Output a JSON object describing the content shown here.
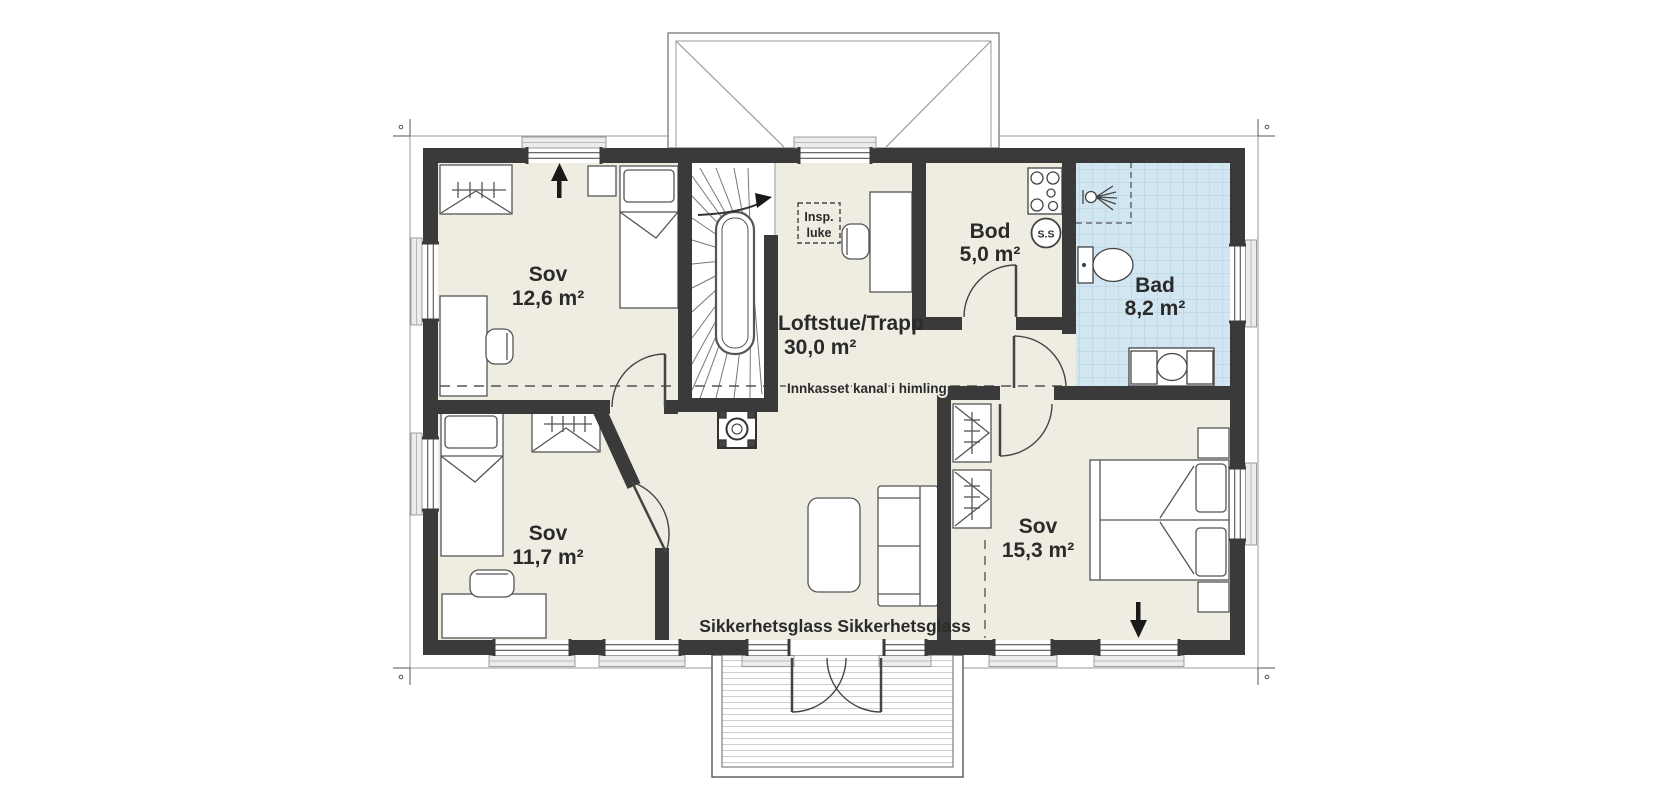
{
  "plan": {
    "type": "floor-plan",
    "floor": "loft / upper floor",
    "colors": {
      "wall": "#3a3a3a",
      "floor": "#efece2",
      "stair_floor": "#ffffff",
      "bathroom_tile": "#d2e6f2",
      "bathroom_tile_grid": "#b3cfdf",
      "furniture_outline": "#555555",
      "text": "#2a2a2a"
    },
    "rooms": [
      {
        "id": "sov-main",
        "name": "Sov",
        "area": "12,6 m²"
      },
      {
        "id": "loftstue",
        "name": "Loftstue/Trapp",
        "area": "30,0 m²"
      },
      {
        "id": "bod",
        "name": "Bod",
        "area": "5,0 m²"
      },
      {
        "id": "bad",
        "name": "Bad",
        "area": "8,2 m²"
      },
      {
        "id": "sov-west",
        "name": "Sov",
        "area": "11,7 m²"
      },
      {
        "id": "sov-east",
        "name": "Sov",
        "area": "15,3 m²"
      }
    ],
    "annotations": {
      "duct_note": "Innkasset kanal i himling",
      "safety_glass": "Sikkerhetsglass Sikkerhetsglass",
      "inspection_line1": "Insp.",
      "inspection_line2": "luke",
      "shaft": "S.S"
    }
  }
}
